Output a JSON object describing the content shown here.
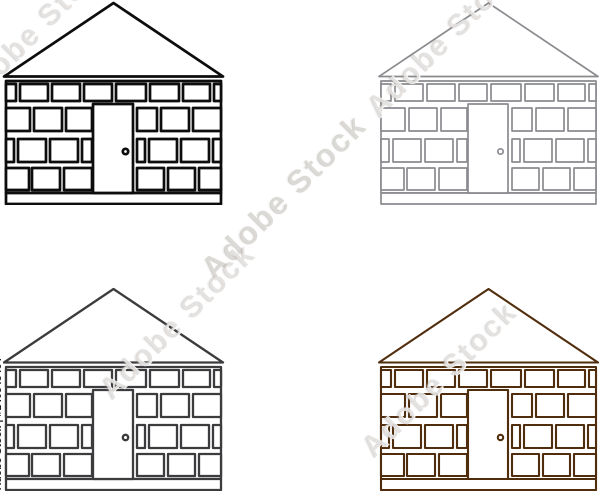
{
  "page": {
    "background": "#ffffff"
  },
  "watermark": {
    "diagonal_text": "Adobe Stock",
    "attribution_text": "Adobe Stock | #140548464",
    "attribution_color": "#1f1f1f"
  },
  "icons": [
    {
      "name": "brick-house-black",
      "color": "#0d0d0d",
      "stroke_width": 2.7
    },
    {
      "name": "brick-house-gray",
      "color": "#8a8b8f",
      "stroke_width": 1.7
    },
    {
      "name": "brick-house-dark-gray",
      "color": "#3c3c3e",
      "stroke_width": 2.3
    },
    {
      "name": "brick-house-brown",
      "color": "#502d0d",
      "stroke_width": 2.1
    }
  ]
}
